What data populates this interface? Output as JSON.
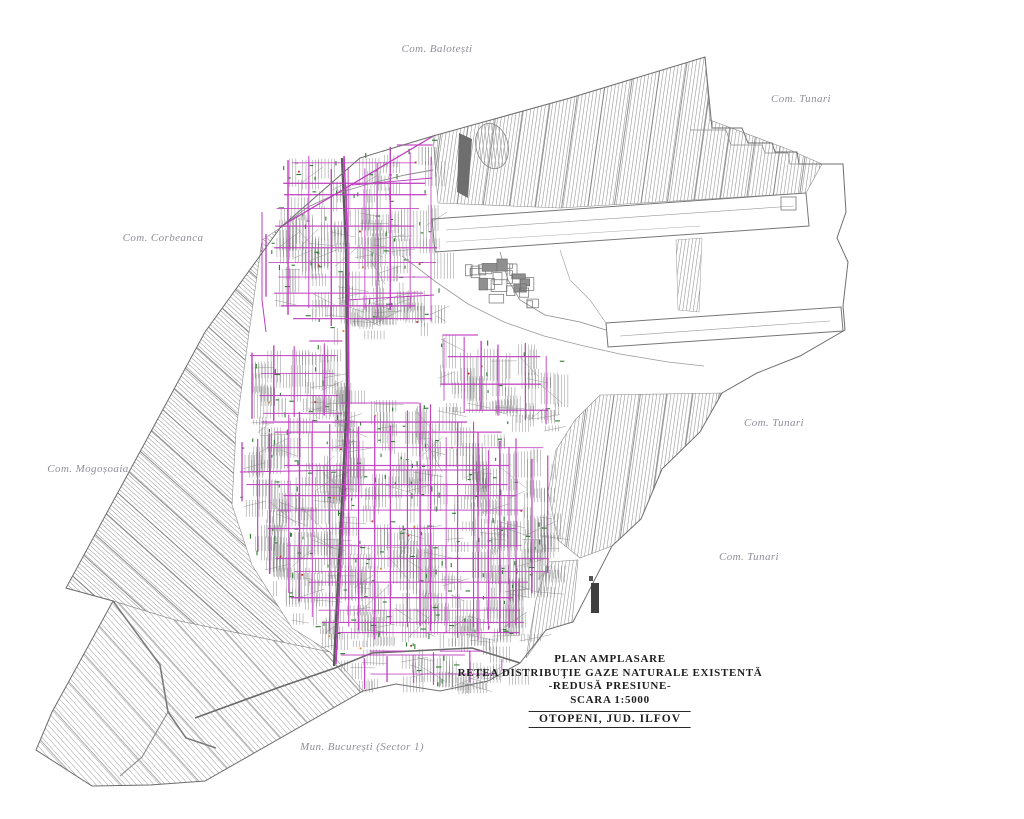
{
  "page": {
    "background": "#ffffff",
    "kind": "cadastral site plan drawing"
  },
  "title_block": {
    "line1": "PLAN  AMPLASARE",
    "line2": "REȚEA  DISTRIBUȚIE  GAZE  NATURALE  EXISTENTĂ",
    "line3": "-REDUSĂ PRESIUNE-",
    "line4": "SCARA 1:5000",
    "location": "OTOPENI,  JUD. ILFOV"
  },
  "neighbor_labels": [
    {
      "id": "com-balotesti",
      "text": "Com. Balotești",
      "x": 437,
      "y": 49
    },
    {
      "id": "com-tunari-north",
      "text": "Com. Tunari",
      "x": 801,
      "y": 99
    },
    {
      "id": "com-corbeanca",
      "text": "Com. Corbeanca",
      "x": 163,
      "y": 238
    },
    {
      "id": "com-tunari-east",
      "text": "Com. Tunari",
      "x": 774,
      "y": 423
    },
    {
      "id": "com-mogosoaia",
      "text": "Com. Mogoșoaia",
      "x": 88,
      "y": 469
    },
    {
      "id": "com-tunari-southeast",
      "text": "Com. Tunari",
      "x": 749,
      "y": 557
    },
    {
      "id": "mun-bucuresti",
      "text": "Mun. București (Sector 1)",
      "x": 362,
      "y": 747
    }
  ],
  "legend_colors": {
    "gas_pipeline": "#bf3cbf",
    "parcel_lines": "#7a7a7a",
    "service_marks": "#2e7d32",
    "dot_orange": "#d9882b",
    "dot_red": "#c43030",
    "label_text": "#8f8f97",
    "title_text": "#1e1e1e"
  },
  "map_geometry": {
    "seed": 1337,
    "boundary": [
      [
        280,
        228
      ],
      [
        360,
        158
      ],
      [
        433,
        136
      ],
      [
        570,
        98
      ],
      [
        705,
        57
      ],
      [
        712,
        128
      ],
      [
        742,
        128
      ],
      [
        748,
        143
      ],
      [
        772,
        143
      ],
      [
        775,
        152
      ],
      [
        797,
        152
      ],
      [
        799,
        164
      ],
      [
        843,
        164
      ],
      [
        846,
        212
      ],
      [
        837,
        238
      ],
      [
        848,
        262
      ],
      [
        843,
        306
      ],
      [
        845,
        330
      ],
      [
        800,
        356
      ],
      [
        757,
        373
      ],
      [
        722,
        393
      ],
      [
        700,
        432
      ],
      [
        662,
        469
      ],
      [
        641,
        519
      ],
      [
        612,
        546
      ],
      [
        573,
        622
      ],
      [
        546,
        630
      ],
      [
        520,
        663
      ],
      [
        488,
        681
      ],
      [
        440,
        691
      ],
      [
        396,
        684
      ],
      [
        363,
        691
      ],
      [
        205,
        781
      ],
      [
        150,
        785
      ],
      [
        92,
        786
      ],
      [
        36,
        750
      ],
      [
        52,
        712
      ],
      [
        113,
        601
      ],
      [
        66,
        588
      ],
      [
        205,
        332
      ]
    ],
    "patterns": [
      {
        "id": "p-steep",
        "angle": 8,
        "spacing": 3.5,
        "color": "#8d8d8d",
        "w": 0.55
      },
      {
        "id": "p-steep-band",
        "angle": 8,
        "spacing": 26,
        "color": "#787878",
        "w": 0.8
      },
      {
        "id": "p-diag",
        "angle": -48,
        "spacing": 3.4,
        "color": "#8f8f8f",
        "w": 0.5
      },
      {
        "id": "p-diag-band",
        "angle": -48,
        "spacing": 23,
        "color": "#737373",
        "w": 0.8
      },
      {
        "id": "p-diag-light",
        "angle": -42,
        "spacing": 4.3,
        "color": "#9c9c9c",
        "w": 0.5
      },
      {
        "id": "p-diag-light-band",
        "angle": -42,
        "spacing": 30,
        "color": "#8a8a8a",
        "w": 0.7
      },
      {
        "id": "p-horiz",
        "angle": -7,
        "spacing": 5,
        "color": "#aaaaaa",
        "w": 0.5
      }
    ],
    "regions": [
      {
        "pts": [
          [
            433,
            136
          ],
          [
            570,
            98
          ],
          [
            705,
            57
          ],
          [
            710,
            120
          ],
          [
            790,
            150
          ],
          [
            822,
            164
          ],
          [
            806,
            193
          ],
          [
            560,
            208
          ],
          [
            438,
            203
          ]
        ],
        "pattern": "p-steep",
        "band": "p-steep-band"
      },
      {
        "pts": [
          [
            280,
            228
          ],
          [
            262,
            240
          ],
          [
            248,
            340
          ],
          [
            236,
            430
          ],
          [
            232,
            505
          ],
          [
            252,
            565
          ],
          [
            292,
            628
          ],
          [
            330,
            652
          ],
          [
            175,
            620
          ],
          [
            113,
            601
          ],
          [
            66,
            588
          ],
          [
            205,
            332
          ]
        ],
        "pattern": "p-diag",
        "band": "p-diag-band"
      },
      {
        "pts": [
          [
            330,
            652
          ],
          [
            363,
            691
          ],
          [
            205,
            781
          ],
          [
            150,
            785
          ],
          [
            92,
            786
          ],
          [
            36,
            750
          ],
          [
            52,
            712
          ],
          [
            113,
            601
          ],
          [
            175,
            620
          ]
        ],
        "pattern": "p-diag-light",
        "band": "p-diag-light-band"
      },
      {
        "pts": [
          [
            600,
            395
          ],
          [
            722,
            393
          ],
          [
            700,
            432
          ],
          [
            662,
            469
          ],
          [
            641,
            519
          ],
          [
            612,
            546
          ],
          [
            580,
            558
          ],
          [
            558,
            540
          ],
          [
            548,
            492
          ],
          [
            556,
            450
          ],
          [
            575,
            420
          ]
        ],
        "pattern": "p-steep",
        "band": "p-steep-band"
      },
      {
        "pts": [
          [
            548,
            562
          ],
          [
            578,
            560
          ],
          [
            572,
            622
          ],
          [
            546,
            630
          ],
          [
            526,
            658
          ],
          [
            536,
            600
          ]
        ],
        "pattern": "p-steep"
      }
    ],
    "airport": [
      {
        "type": "polygon",
        "pts": [
          [
            432,
            219
          ],
          [
            806,
            193
          ],
          [
            809,
            226
          ],
          [
            435,
            252
          ]
        ],
        "stroke": "#777777",
        "w": 1
      },
      {
        "type": "polyline",
        "pts": [
          [
            446,
            230
          ],
          [
            794,
            206
          ]
        ],
        "stroke": "#999999",
        "w": 0.6
      },
      {
        "type": "polyline",
        "pts": [
          [
            446,
            242
          ],
          [
            700,
            226
          ]
        ],
        "stroke": "#aaaaaa",
        "w": 0.5
      },
      {
        "type": "rect",
        "x": 781,
        "y": 197,
        "wd": 15,
        "ht": 13,
        "stroke": "#777777",
        "w": 0.8
      },
      {
        "type": "polygon",
        "pts": [
          [
            606,
            323
          ],
          [
            841,
            307
          ],
          [
            843,
            331
          ],
          [
            608,
            347
          ]
        ],
        "stroke": "#777777",
        "w": 1
      },
      {
        "type": "polyline",
        "pts": [
          [
            620,
            336
          ],
          [
            830,
            321
          ]
        ],
        "stroke": "#999999",
        "w": 0.6
      },
      {
        "type": "polyline",
        "pts": [
          [
            500,
            252
          ],
          [
            508,
            280
          ],
          [
            520,
            300
          ],
          [
            545,
            315
          ],
          [
            580,
            322
          ],
          [
            606,
            330
          ]
        ],
        "stroke": "#8a8a8a",
        "w": 0.8
      },
      {
        "type": "polyline",
        "pts": [
          [
            560,
            250
          ],
          [
            570,
            280
          ],
          [
            590,
            300
          ],
          [
            606,
            323
          ]
        ],
        "stroke": "#9a9a9a",
        "w": 0.6
      },
      {
        "type": "polyline",
        "pts": [
          [
            690,
            130
          ],
          [
            726,
            130
          ],
          [
            731,
            145
          ],
          [
            762,
            145
          ],
          [
            765,
            153
          ],
          [
            788,
            153
          ],
          [
            790,
            164
          ],
          [
            843,
            164
          ]
        ],
        "stroke": "#8a8a8a",
        "w": 0.7
      },
      {
        "type": "polygon",
        "pts": [
          [
            676,
            240
          ],
          [
            702,
            238
          ],
          [
            699,
            312
          ],
          [
            678,
            310
          ]
        ],
        "stroke": "#999999",
        "w": 0.5,
        "fillpat": "p-steep"
      },
      {
        "type": "ellipse",
        "cx": 492,
        "cy": 146,
        "rx": 16,
        "ry": 23,
        "rot": -14,
        "stroke": "#8a8a8a",
        "w": 0.8
      },
      {
        "type": "polygon",
        "pts": [
          [
            459,
            133
          ],
          [
            472,
            139
          ],
          [
            468,
            198
          ],
          [
            457,
            192
          ]
        ],
        "fill": "#6e6e6e"
      }
    ],
    "terminal_bbox": {
      "x": 452,
      "y": 258,
      "w": 110,
      "h": 52,
      "count": 22
    },
    "roads": [
      {
        "pts": [
          [
            342,
            158
          ],
          [
            346,
            250
          ],
          [
            347,
            400
          ],
          [
            341,
            520
          ],
          [
            336,
            620
          ],
          [
            334,
            666
          ]
        ],
        "stroke": "#5a5a5a",
        "w": 2.3
      },
      {
        "pts": [
          [
            113,
            601
          ],
          [
            160,
            665
          ],
          [
            168,
            712
          ],
          [
            186,
            738
          ],
          [
            216,
            748
          ]
        ],
        "stroke": "#7b7b7b",
        "w": 1.6
      },
      {
        "pts": [
          [
            168,
            712
          ],
          [
            142,
            757
          ],
          [
            120,
            776
          ]
        ],
        "stroke": "#8a8a8a",
        "w": 1.1
      },
      {
        "pts": [
          [
            195,
            718
          ],
          [
            280,
            687
          ],
          [
            335,
            668
          ],
          [
            372,
            653
          ],
          [
            432,
            650
          ],
          [
            472,
            648
          ],
          [
            520,
            663
          ]
        ],
        "stroke": "#6a6a6a",
        "w": 1.6
      },
      {
        "pts": [
          [
            280,
            228
          ],
          [
            308,
            207
          ],
          [
            338,
            193
          ],
          [
            372,
            183
          ],
          [
            405,
            175
          ],
          [
            433,
            170
          ]
        ],
        "stroke": "#8a8a8a",
        "w": 0.9
      },
      {
        "pts": [
          [
            402,
            256
          ],
          [
            436,
            282
          ],
          [
            468,
            304
          ],
          [
            504,
            322
          ],
          [
            544,
            336
          ],
          [
            584,
            346
          ],
          [
            620,
            354
          ],
          [
            668,
            362
          ],
          [
            704,
            366
          ]
        ],
        "stroke": "#9a9a9a",
        "w": 0.8
      }
    ],
    "gas_trunks": [
      {
        "pts": [
          [
            280,
            227
          ],
          [
            435,
            135
          ]
        ],
        "w": 1.3
      },
      {
        "pts": [
          [
            344,
            156
          ],
          [
            348,
            250
          ],
          [
            349,
            400
          ],
          [
            343,
            520
          ],
          [
            338,
            620
          ],
          [
            336,
            664
          ]
        ],
        "w": 1.5
      },
      {
        "pts": [
          [
            262,
            212
          ],
          [
            262,
            300
          ],
          [
            266,
            332
          ]
        ],
        "w": 1.0
      },
      {
        "pts": [
          [
            478,
            432
          ],
          [
            478,
            640
          ]
        ],
        "w": 1.2
      },
      {
        "pts": [
          [
            509,
            447
          ],
          [
            509,
            628
          ]
        ],
        "w": 1.0
      },
      {
        "pts": [
          [
            240,
            472
          ],
          [
            346,
            470
          ]
        ],
        "w": 1.0
      },
      {
        "pts": [
          [
            347,
            470
          ],
          [
            477,
            470
          ]
        ],
        "w": 1.0
      },
      {
        "pts": [
          [
            346,
            300
          ],
          [
            434,
            295
          ]
        ],
        "w": 0.9
      },
      {
        "pts": [
          [
            352,
            185
          ],
          [
            432,
            178
          ]
        ],
        "w": 0.9
      }
    ],
    "zones": [
      {
        "id": "north-cluster",
        "poly": [
          [
            285,
            158
          ],
          [
            433,
            140
          ],
          [
            438,
            208
          ],
          [
            440,
            325
          ],
          [
            395,
            330
          ],
          [
            340,
            332
          ],
          [
            292,
            320
          ],
          [
            266,
            300
          ],
          [
            262,
            240
          ]
        ],
        "strips": 110,
        "mvx": 17,
        "mvy": 16,
        "greens": 60,
        "dots": 8
      },
      {
        "id": "central-cluster",
        "poly": [
          [
            250,
            425
          ],
          [
            330,
            402
          ],
          [
            420,
            398
          ],
          [
            470,
            420
          ],
          [
            520,
            438
          ],
          [
            556,
            452
          ],
          [
            549,
            500
          ],
          [
            560,
            545
          ],
          [
            545,
            582
          ],
          [
            520,
            640
          ],
          [
            470,
            655
          ],
          [
            430,
            650
          ],
          [
            372,
            653
          ],
          [
            300,
            628
          ],
          [
            256,
            560
          ],
          [
            238,
            490
          ],
          [
            240,
            445
          ]
        ],
        "strips": 300,
        "mvx": 14,
        "mvy": 14,
        "greens": 150,
        "dots": 16
      },
      {
        "id": "south-fringe",
        "poly": [
          [
            332,
            652
          ],
          [
            372,
            655
          ],
          [
            430,
            652
          ],
          [
            470,
            650
          ],
          [
            518,
            664
          ],
          [
            488,
            680
          ],
          [
            440,
            690
          ],
          [
            396,
            683
          ],
          [
            363,
            690
          ]
        ],
        "strips": 26,
        "mvx": 26,
        "mvy": 20,
        "greens": 8,
        "dots": 0
      },
      {
        "id": "west-fringe",
        "poly": [
          [
            248,
            348
          ],
          [
            345,
            336
          ],
          [
            346,
            420
          ],
          [
            250,
            422
          ]
        ],
        "strips": 40,
        "mvx": 22,
        "mvy": 18,
        "greens": 12,
        "dots": 2
      },
      {
        "id": "east-lobe",
        "poly": [
          [
            440,
            330
          ],
          [
            520,
            340
          ],
          [
            560,
            360
          ],
          [
            556,
            430
          ],
          [
            470,
            418
          ],
          [
            440,
            400
          ]
        ],
        "strips": 40,
        "mvx": 24,
        "mvy": 20,
        "greens": 10,
        "dots": 2
      }
    ],
    "extras": [
      {
        "type": "rect",
        "x": 591,
        "y": 583,
        "wd": 8,
        "ht": 30,
        "fill": "#3f3f3f"
      },
      {
        "type": "rect",
        "x": 589,
        "y": 576,
        "wd": 4,
        "ht": 5,
        "fill": "#555555"
      }
    ]
  }
}
